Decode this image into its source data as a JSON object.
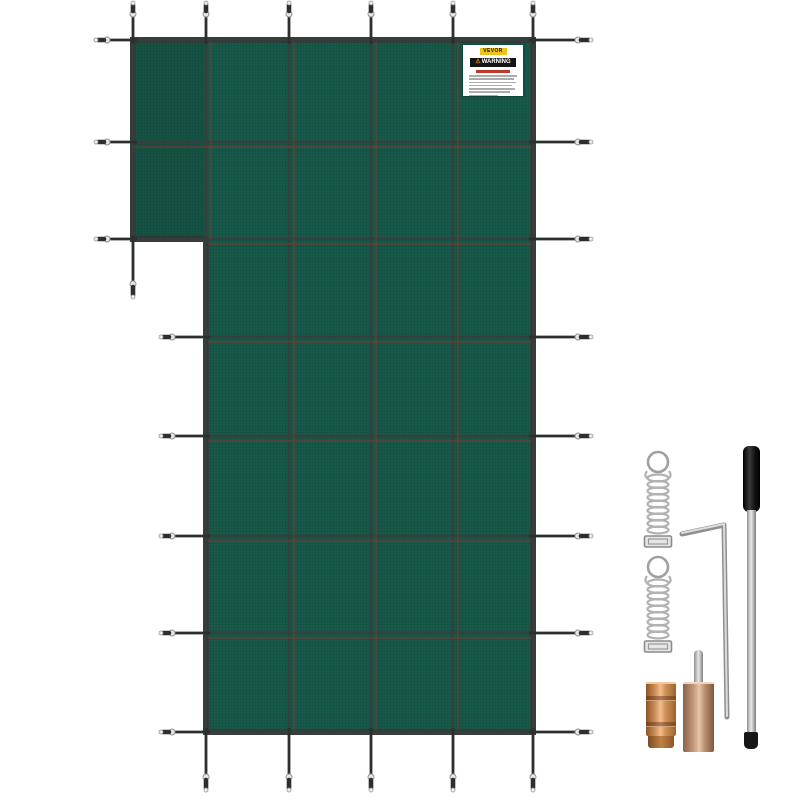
{
  "label": {
    "brand": "VEVOR",
    "warning_title": "WARNING"
  },
  "icons": {
    "warning_triangle": "⚠"
  },
  "colors": {
    "background": "#ffffff",
    "cover_green": "#17594a",
    "edge_dark": "#363d3b",
    "grid_line": "#33403c",
    "stitch_red": "#6f3d33",
    "strap_dark": "#2b302e",
    "hardware_silver": "#b2b2b2",
    "hardware_light": "#e8e8e8",
    "rod_black": "#161616",
    "shaft_silver_light": "#ececec",
    "shaft_silver_dark": "#8f8f8f",
    "anchor_copper_light": "#f3bd8c",
    "anchor_copper_dark": "#8d5526",
    "anchor_rose_light": "#e9c6aa",
    "anchor_rose_dark": "#8a6248",
    "label_yellow": "#f0c41d",
    "label_bar_black": "#141414",
    "warn_red": "#c03a2a",
    "warn_orange": "#f08a1d"
  }
}
